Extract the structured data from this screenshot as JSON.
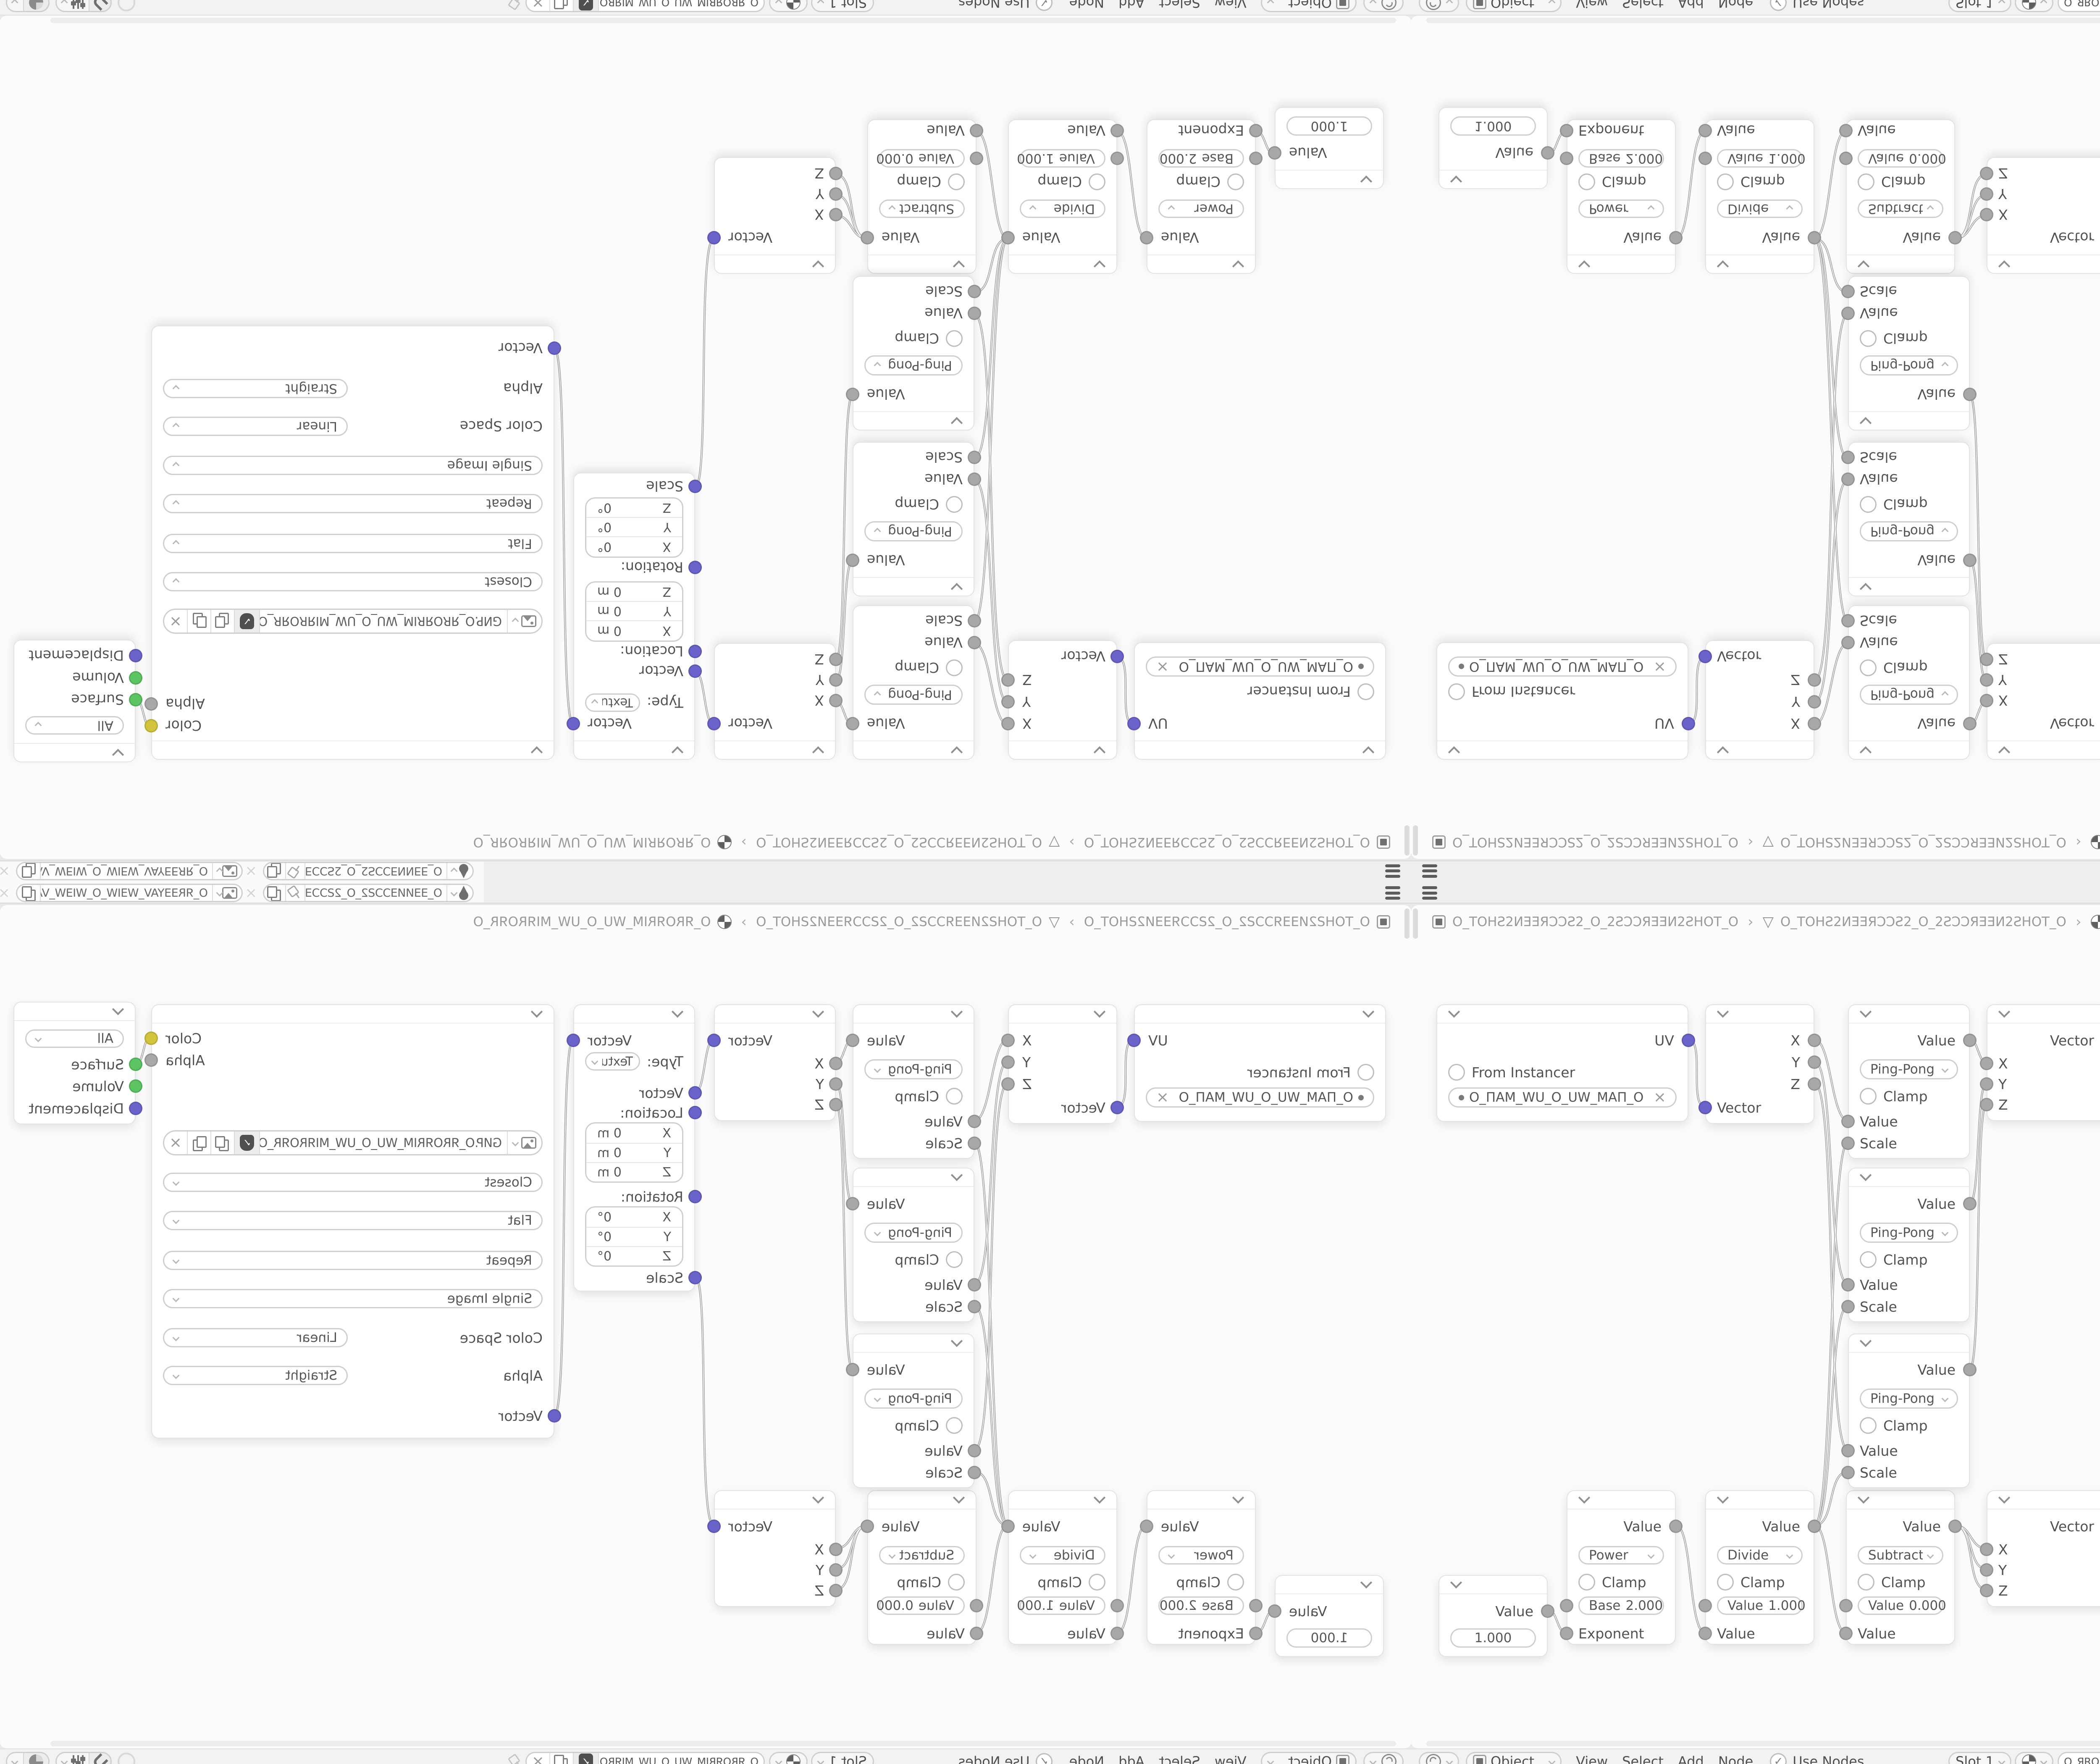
{
  "icons": {
    "close": "×",
    "check": "✓",
    "mesh_triangle": "▽",
    "crumb_sep": "›"
  },
  "colors": {
    "socket_value": "#a8a8a8",
    "socket_vector": "#6a63c9",
    "socket_color": "#d2c43c",
    "socket_shader": "#5cc463",
    "wire": "#a3a3a3",
    "canvas": "#fbfbfb"
  },
  "strip": {
    "datablocks": [
      {
        "icon": "paint-icon",
        "name": "O_ƎƎИИƎƆƆƧ2_O_2ƧƆƆƎƎИ..."
      },
      {
        "icon": "image-icon",
        "name": "O_ЯRƎƎYAV_WƎIW_O_WIƎW_VAYƎƎЯR_O"
      }
    ]
  },
  "breadcrumb": {
    "items": [
      {
        "icon": "object-icon",
        "label": "O_TOHƧ2ИƎƎЯƆƆƧ2_O_2ƧƆƆЯƎƎИ2ƧHOT_O"
      },
      {
        "icon": "mesh-icon",
        "label": "O_TOHƧ2ИƎƎЯƆƆƧ2_O_2ƧƆƆЯƎƎИ2ƧHOT_O"
      },
      {
        "icon": "material-icon",
        "label": "O_ЯROЯRIM_WU_O_UW_MIЯROЯR_O"
      }
    ]
  },
  "header": {
    "shader_type": "Object",
    "menus": [
      "View",
      "Select",
      "Add",
      "Node"
    ],
    "use_nodes": "Use Nodes",
    "slot": "Slot 1",
    "material_name": "O_ЯROЯRIM_WU_O_UW_MIЯROЯR_O"
  },
  "nodes": {
    "uv_map": {
      "output": "UV",
      "checkbox": "From Instancer",
      "uv_name": "O_ПAM_WU_O_UW_MAП_O"
    },
    "separate_xyz": {
      "outputs": [
        "X",
        "Y",
        "Z"
      ],
      "input": "Vector"
    },
    "math_pingpong": {
      "operation": "Ping-Pong",
      "clamp": "Clamp",
      "input1": "Value",
      "input2": "Scale",
      "output": "Value"
    },
    "combine_xyz": {
      "inputs": [
        "X",
        "Y",
        "Z"
      ],
      "output": "Vector"
    },
    "mapping": {
      "output": "Vector",
      "type_label": "Type:",
      "type_value": "Texture",
      "input_vector": "Vector",
      "location_label": "Location:",
      "location_rows": [
        {
          "axis": "X",
          "value": "0 m"
        },
        {
          "axis": "Y",
          "value": "0 m"
        },
        {
          "axis": "Z",
          "value": "0 m"
        }
      ],
      "rotation_label": "Rotation:",
      "rotation_rows": [
        {
          "axis": "X",
          "value": "0°"
        },
        {
          "axis": "Y",
          "value": "0°"
        },
        {
          "axis": "Z",
          "value": "0°"
        }
      ],
      "scale_label": "Scale"
    },
    "image_texture": {
      "output_color": "Color",
      "output_alpha": "Alpha",
      "filename": "GИP.O_ЯROЯRIM_WU_O_UW_MIЯROЯR_O.PNG",
      "interpolation": "Closest",
      "projection": "Flat",
      "extension": "Repeat",
      "source": "Single Image",
      "color_space_label": "Color Space",
      "color_space": "Linear",
      "alpha_label": "Alpha",
      "alpha_mode": "Straight",
      "input": "Vector"
    },
    "material_output": {
      "target": "All",
      "inputs": [
        "Surface",
        "Volume",
        "Displacement"
      ]
    },
    "value": {
      "output": "Value",
      "value": "1.000"
    },
    "math_power": {
      "operation": "Power",
      "clamp": "Clamp",
      "field_label": "Base",
      "field_value": "2.000",
      "input2": "Exponent",
      "output": "Value"
    },
    "math_divide": {
      "operation": "Divide",
      "clamp": "Clamp",
      "field_label": "Value",
      "field_value": "1.000",
      "input2": "Value",
      "output": "Value"
    },
    "math_subtract": {
      "operation": "Subtract",
      "clamp": "Clamp",
      "field_label": "Value",
      "field_value": "0.000",
      "input2": "Value",
      "output": "Value"
    }
  }
}
